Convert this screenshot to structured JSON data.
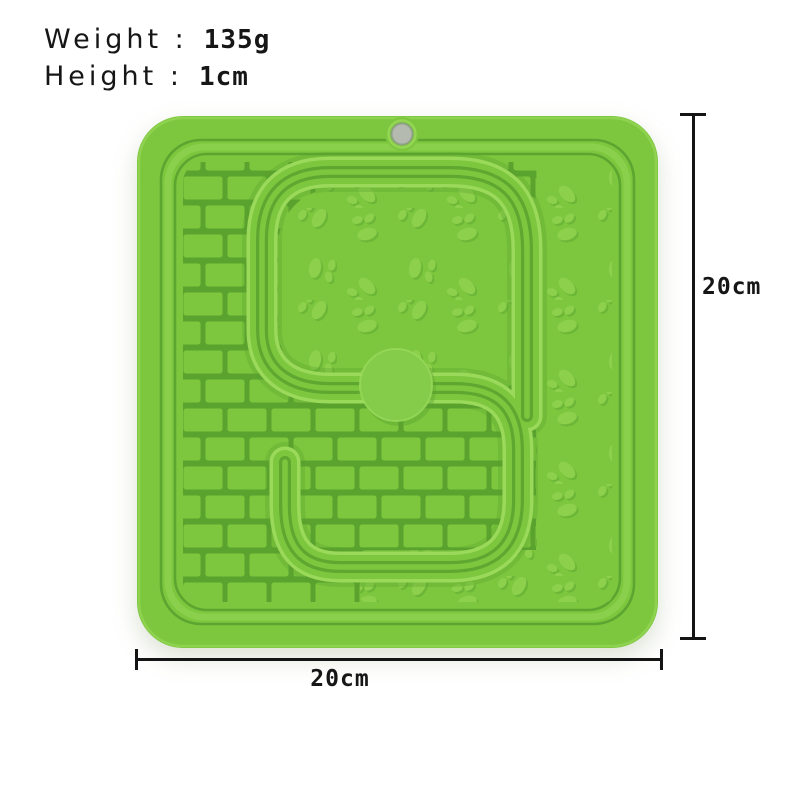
{
  "annotations": {
    "weight_label": "Weight :",
    "weight_value": "135g",
    "height_label": "Height :",
    "height_value": "1cm",
    "side_dimension": "20cm",
    "width_dimension": "20cm"
  },
  "product": {
    "item": "green silicone lick mat",
    "divider_shape": "S"
  },
  "colors": {
    "background": "#ffffff",
    "mat_bright": "#7cc73e",
    "mat_base": "#76c23c",
    "mat_groove": "#5ba32f",
    "mat_groove_dark": "#4f962a",
    "mat_highlight": "#9ad95a",
    "band_top": "#7dc73f",
    "disc_fill": "#84cc4a",
    "bump_fill": "#8cd04c",
    "hole_fill": "#b5bab0",
    "hole_ring": "#8e9c86",
    "dim_line": "#141414",
    "text_color": "#161616"
  }
}
